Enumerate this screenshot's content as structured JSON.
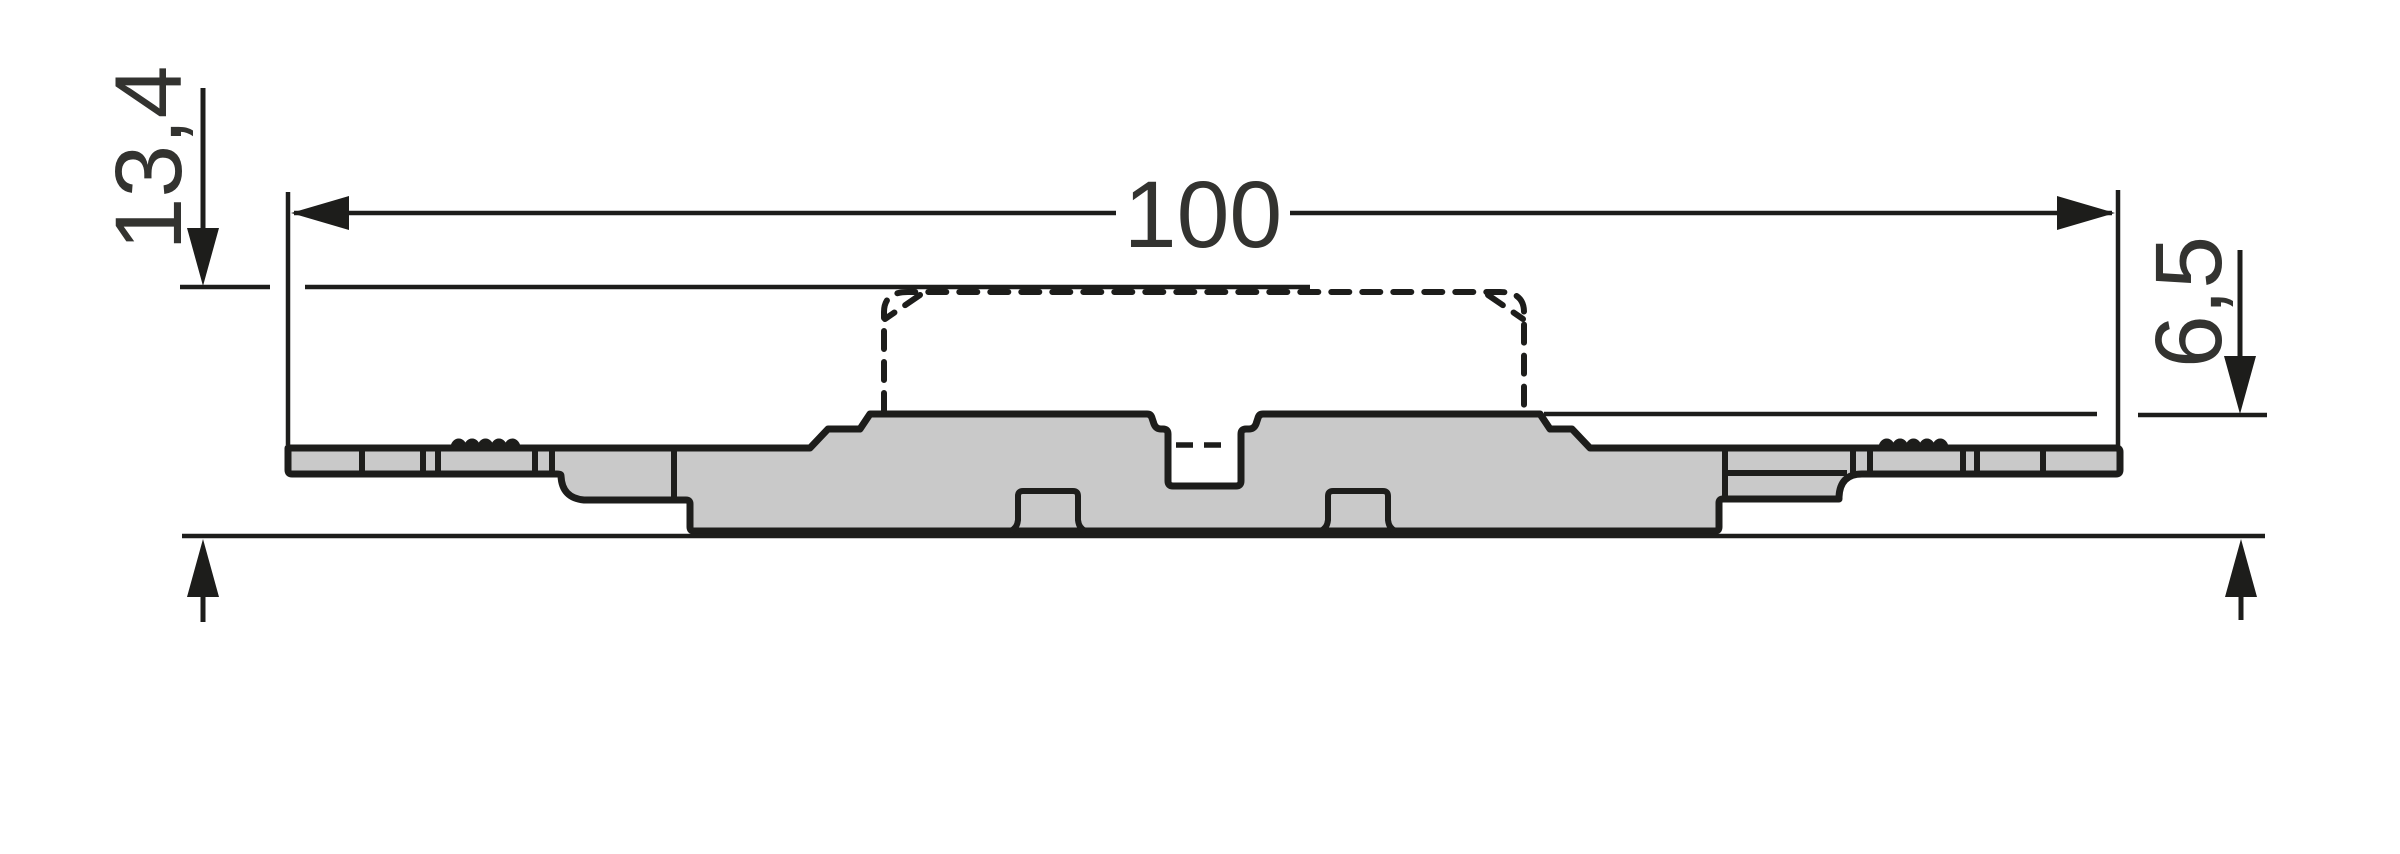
{
  "drawing": {
    "description_labels": {
      "overall_width": "100",
      "total_height": "13,4",
      "upper_height": "6,5"
    },
    "colors": {
      "background": "#ffffff",
      "part_fill": "#c9c9c9",
      "line_color": "#1d1d1b",
      "text_color": "#333330"
    }
  }
}
